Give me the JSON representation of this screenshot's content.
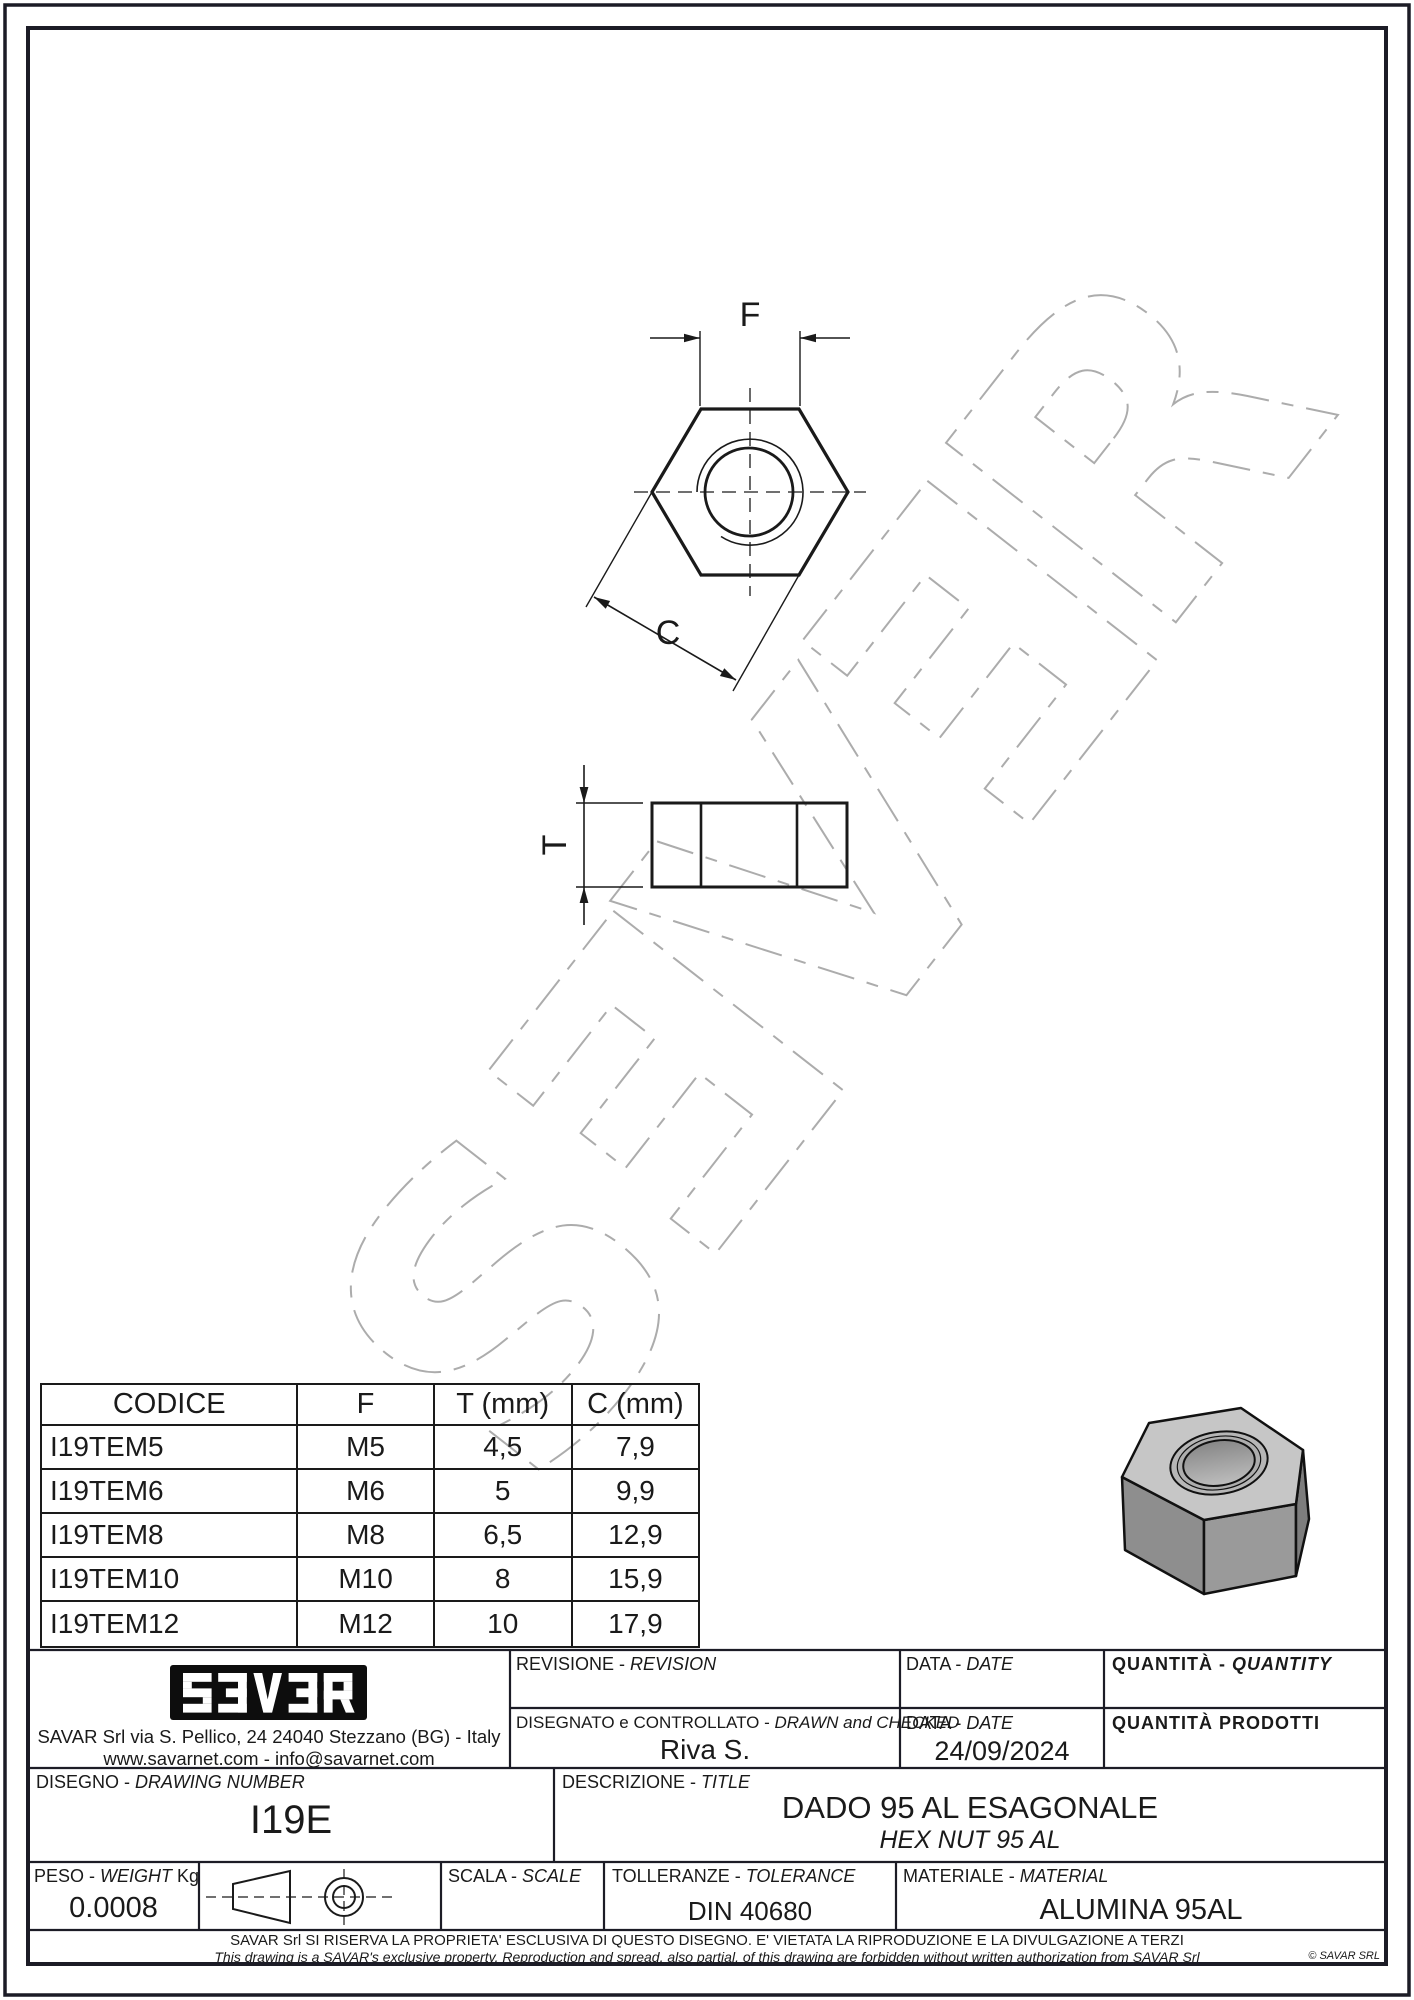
{
  "watermark": {
    "letters": [
      "S",
      "Ǝ",
      "V",
      "Ǝ",
      "R"
    ]
  },
  "views": {
    "width_across_flats_label": "F",
    "width_across_corners_label": "C",
    "thickness_label": "T"
  },
  "table": {
    "headers": [
      "CODICE",
      "F",
      "T (mm)",
      "C (mm)"
    ],
    "rows": [
      [
        "I19TEM5",
        "M5",
        "4,5",
        "7,9"
      ],
      [
        "I19TEM6",
        "M6",
        "5",
        "9,9"
      ],
      [
        "I19TEM8",
        "M8",
        "6,5",
        "12,9"
      ],
      [
        "I19TEM10",
        "M10",
        "8",
        "15,9"
      ],
      [
        "I19TEM12",
        "M12",
        "10",
        "17,9"
      ]
    ]
  },
  "company": {
    "logo_text": "SƎVƎR",
    "address": "SAVAR Srl via S. Pellico, 24  24040 Stezzano (BG) - Italy",
    "web_email": "www.savarnet.com  -  info@savarnet.com"
  },
  "title_block": {
    "revision": {
      "label_it": "REVISIONE -",
      "label_en": "REVISION",
      "value": ""
    },
    "drawn": {
      "label_it": "DISEGNATO e CONTROLLATO -",
      "label_en": "DRAWN and CHECKED",
      "value": "Riva S."
    },
    "date_top": {
      "label_it": "DATA -",
      "label_en": "DATE",
      "value": ""
    },
    "date": {
      "label_it": "DATA -",
      "label_en": "DATE",
      "value": "24/09/2024"
    },
    "quantity": {
      "label_it": "QUANTITÀ -",
      "label_en": "QUANTITY",
      "value": ""
    },
    "quantity_produced": {
      "label": "QUANTITÀ  PRODOTTI",
      "value": ""
    },
    "drawing_number": {
      "label_it": "DISEGNO -",
      "label_en": "DRAWING NUMBER",
      "value": "I19E"
    },
    "description": {
      "label_it": "DESCRIZIONE -",
      "label_en": "TITLE",
      "value_it": "DADO 95 AL ESAGONALE",
      "value_en": "HEX NUT 95 AL"
    },
    "weight": {
      "label_it": "PESO -",
      "label_en": "WEIGHT",
      "unit": "Kg",
      "value": "0.0008"
    },
    "scale": {
      "label_it": "SCALA -",
      "label_en": "SCALE",
      "value": ""
    },
    "tolerance": {
      "label_it": "TOLLERANZE -",
      "label_en": "TOLERANCE",
      "value": "DIN 40680"
    },
    "material": {
      "label_it": "MATERIALE -",
      "label_en": "MATERIAL",
      "value": "ALUMINA 95AL"
    }
  },
  "footer": {
    "line1": "SAVAR Srl SI RISERVA LA PROPRIETA' ESCLUSIVA DI QUESTO DISEGNO. E' VIETATA LA RIPRODUZIONE E LA DIVULGAZIONE A TERZI",
    "line2": "This drawing is a SAVAR's exclusive property. Reproduction and spread, also partial, of this drawing are forbidden without written authorization from SAVAR Srl",
    "copyright": "© SAVAR SRL"
  },
  "colors": {
    "line": "#1a1a1a",
    "border": "#1c1c26",
    "watermark": "#acacac",
    "nut_top": "#c6c6c6",
    "nut_left": "#8e8e8e",
    "nut_front": "#9a9a9a",
    "nut_right": "#7d7d7d"
  }
}
